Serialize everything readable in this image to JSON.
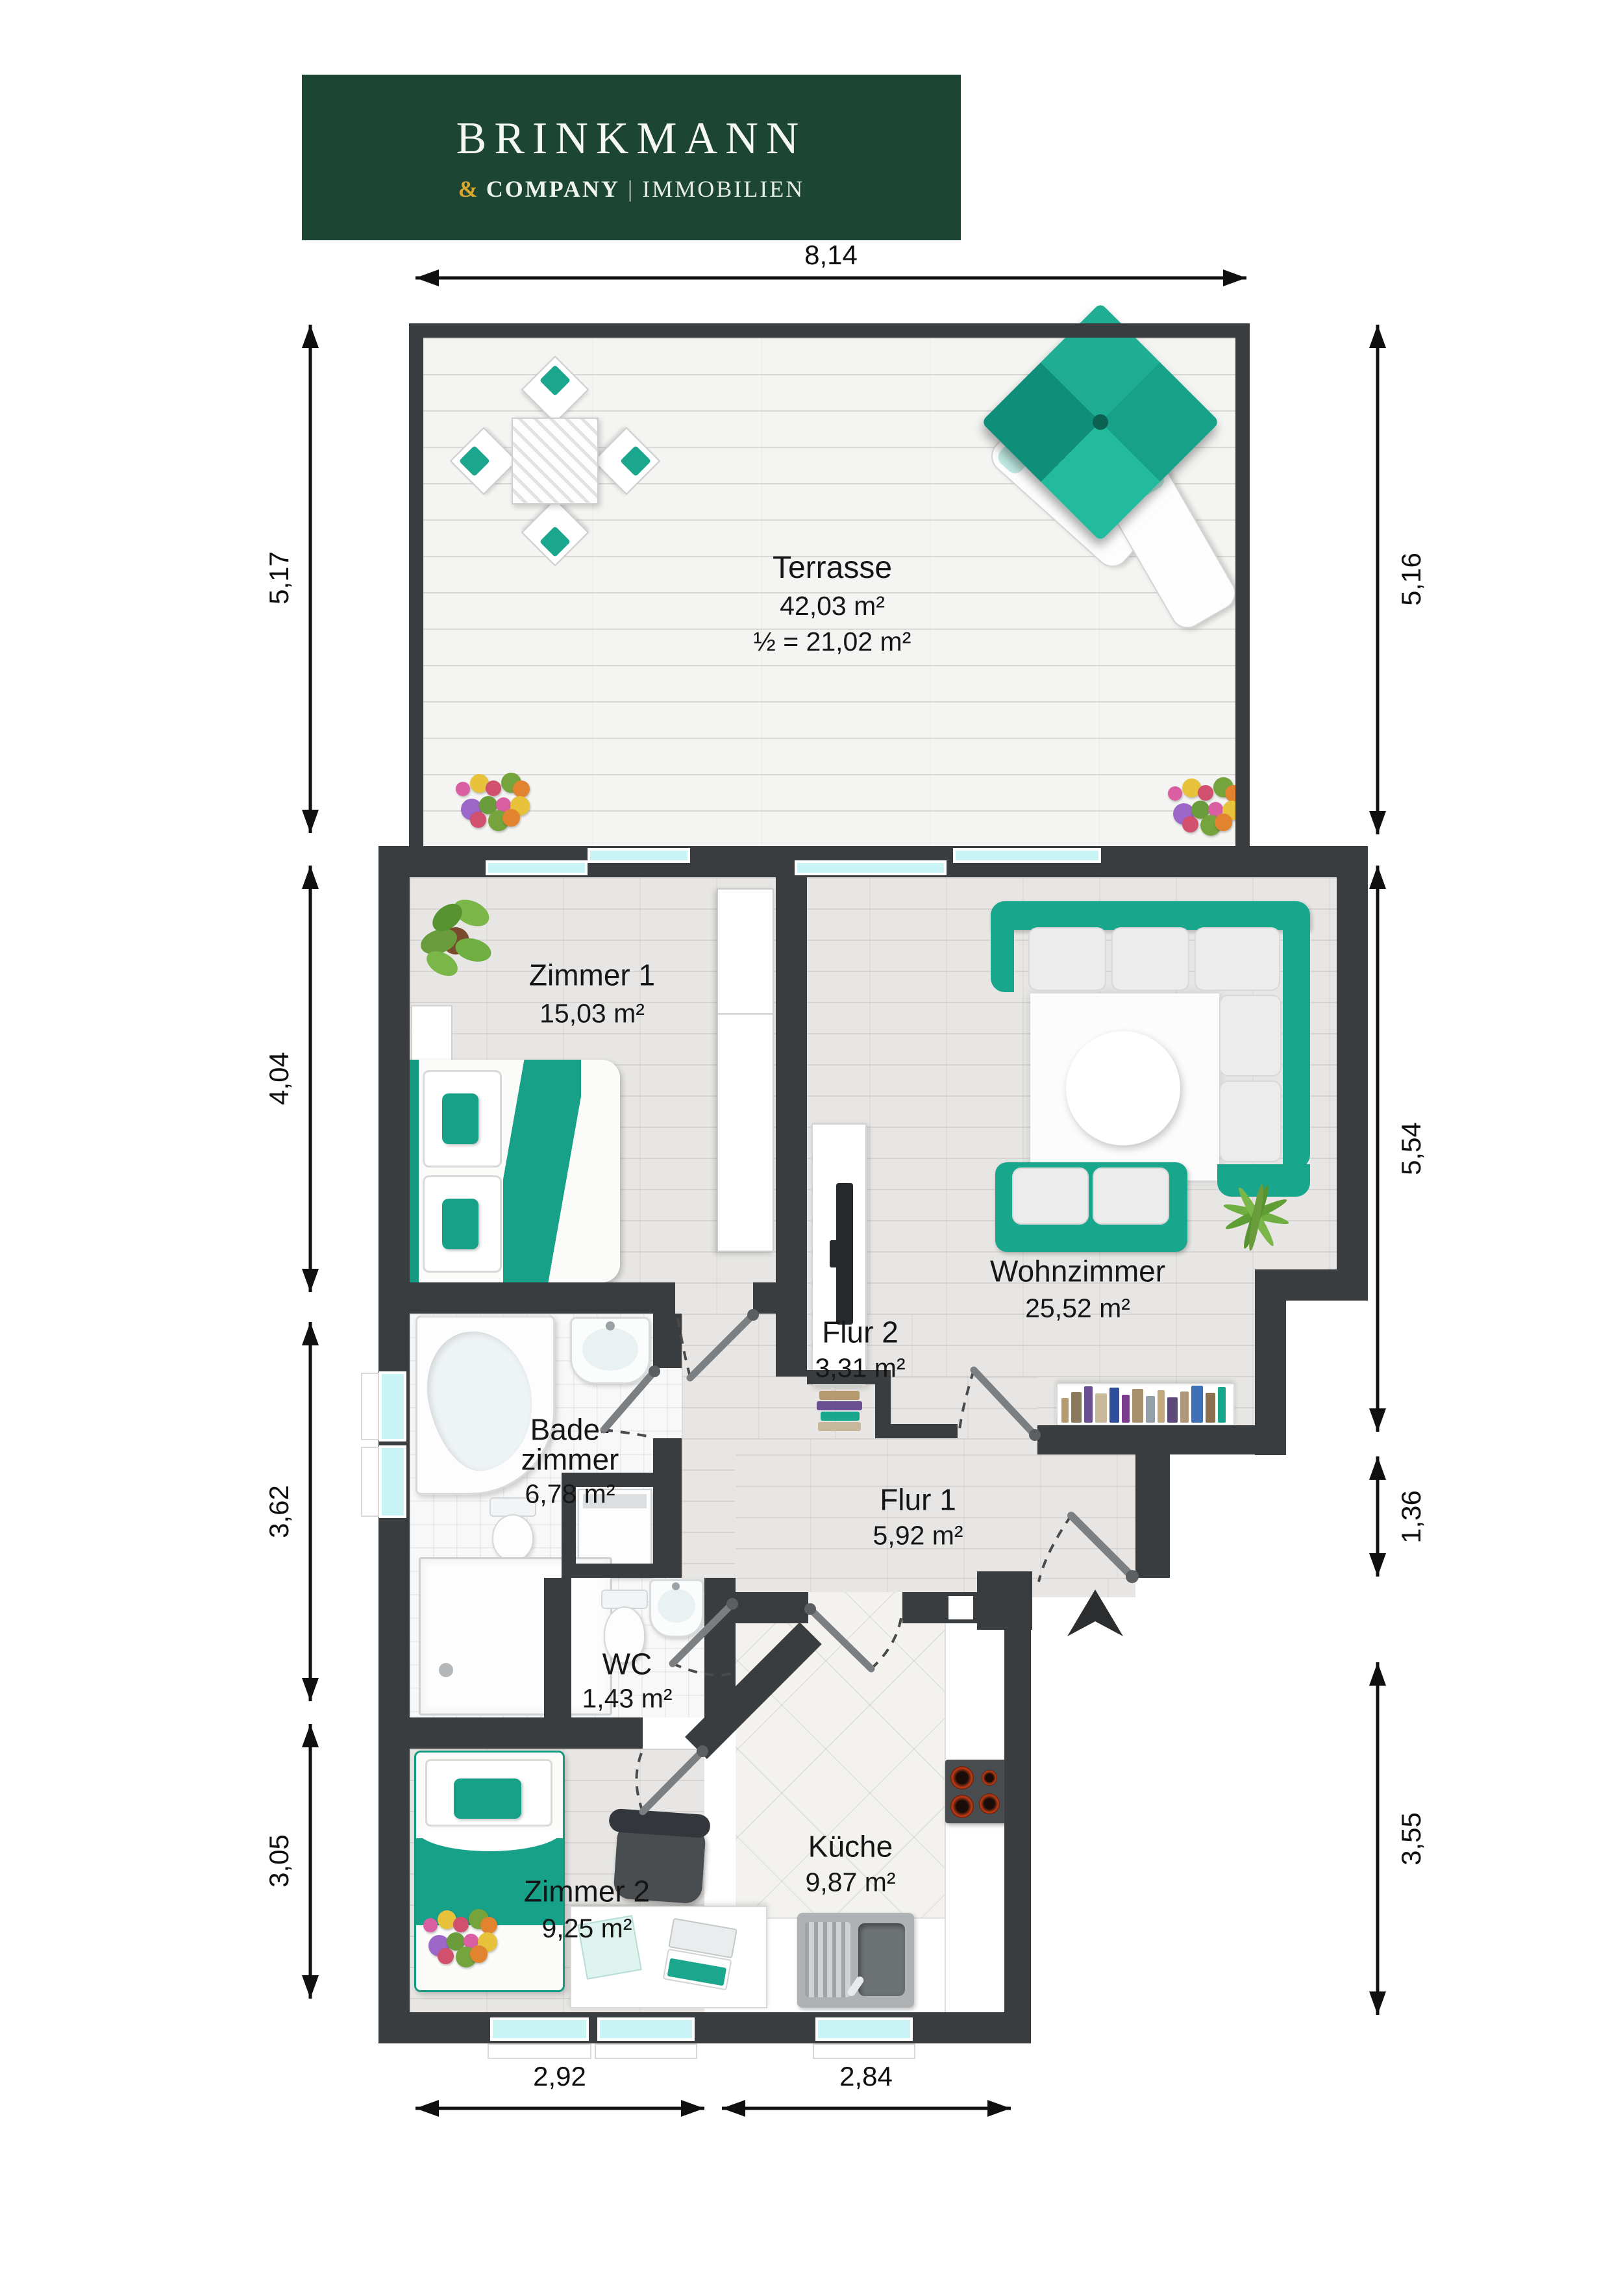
{
  "logo": {
    "line1": "BRINKMANN",
    "amp": "&",
    "company": "COMPANY",
    "divider": "|",
    "suffix": "IMMOBILIEN",
    "bg": "#1d4533",
    "gold": "#d9a62e"
  },
  "dimensions": {
    "top": [
      "8,14"
    ],
    "left": [
      "5,17",
      "4,04",
      "3,62",
      "3,05"
    ],
    "right": [
      "5,16",
      "5,54",
      "1,36",
      "3,55"
    ],
    "bottom": [
      "2,92",
      "2,84"
    ]
  },
  "rooms": {
    "terrasse": {
      "name": "Terrasse",
      "area": "42,03 m²",
      "area_half": "½ = 21,02 m²"
    },
    "zimmer1": {
      "name": "Zimmer 1",
      "area": "15,03 m²"
    },
    "wohnzimmer": {
      "name": "Wohnzimmer",
      "area": "25,52 m²"
    },
    "badezimmer": {
      "name": "Bade-",
      "name2": "zimmer",
      "area": "6,78 m²"
    },
    "flur2": {
      "name": "Flur 2",
      "area": "3,31 m²"
    },
    "flur1": {
      "name": "Flur 1",
      "area": "5,92 m²"
    },
    "wc": {
      "name": "WC",
      "area": "1,43 m²"
    },
    "zimmer2": {
      "name": "Zimmer 2",
      "area": "9,25 m²"
    },
    "kueche": {
      "name": "Küche",
      "area": "9,87 m²"
    }
  },
  "colors": {
    "accent_teal": "#18a78c",
    "wall": "#3a3d40",
    "window_glass": "#c9f4f6",
    "door_leaf": "#7c7f82"
  },
  "palette": {
    "book_spines": [
      "#b59a6f",
      "#8a7a5c",
      "#6b4f93",
      "#c7b79b",
      "#2f4e9e",
      "#7d3b8f",
      "#a8906c",
      "#94a0a8",
      "#c2a77f",
      "#5d4a7a",
      "#b0977a",
      "#3f6fb5",
      "#8d6e4f",
      "#18a78c"
    ],
    "flowers": [
      "#d95fa2",
      "#e8c23a",
      "#d0506e",
      "#76a43c",
      "#e2842f",
      "#9c67c9",
      "#6a9c3c"
    ]
  }
}
